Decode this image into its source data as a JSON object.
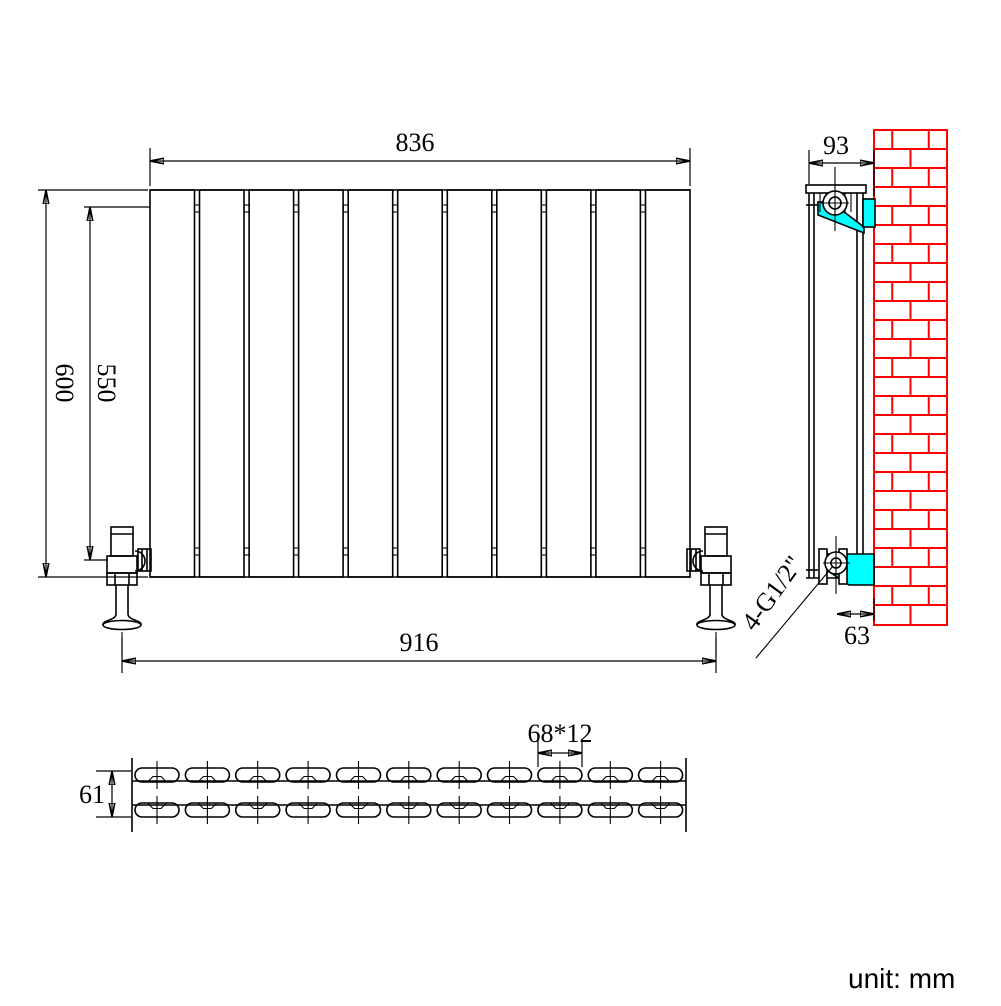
{
  "front_view": {
    "panel_count": 11,
    "dims": {
      "width_top": "836",
      "height_overall": "600",
      "height_connection": "550",
      "valve_span": "916"
    }
  },
  "side_view": {
    "dims": {
      "depth_top": "93",
      "wall_offset_bottom": "63"
    },
    "connection_label": "4-G1/2\""
  },
  "top_view": {
    "section_count": 11,
    "dims": {
      "depth": "61",
      "section_pitch": "68*12"
    }
  },
  "unit_note": "unit: mm",
  "colors": {
    "line": "#000000",
    "bracket_highlight": "#00ffff",
    "brick_wall": "#ff0000",
    "background": "#ffffff"
  }
}
